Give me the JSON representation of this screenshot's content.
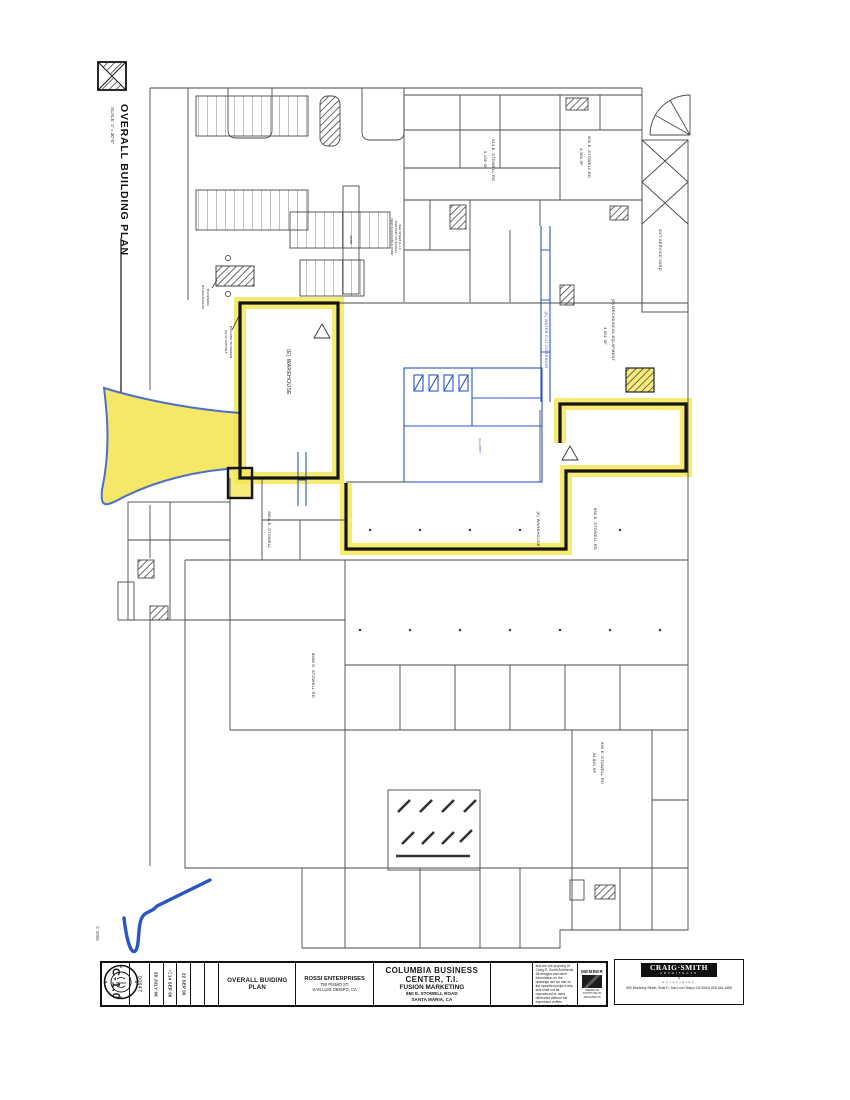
{
  "sheet": {
    "drawing_title": "OVERALL BUILDING PLAN",
    "drawing_scale": "SCALE: 1\" = 30'-0\"",
    "copyright": "© 2006",
    "plan_labels": {
      "warehouse_upper": "(E) WAREHOUSE",
      "warehouse_lower": "(E) WAREHOUSE",
      "suite_614_name": "614 E. STOWELL RD",
      "suite_614_area": "9,135 SF",
      "suite_600_name": "600 E. STOWELL RD",
      "suite_600_area": "4,385 SF",
      "water_cut_corridor": "(E) WATER CUT CORRIDOR",
      "mechanical_name": "(E) MECHANICAL EQUIPMENT",
      "mechanical_area": "4,591 SF",
      "ext_service_yard": "EXT SERVICE YARD",
      "ada_access_1": "(E) ADA ACCESS",
      "ada_access_2": "TO REMAIN",
      "asphalt_1": "(E) 12' ASPHALT",
      "asphalt_2": "BUILDING TO REMAIN",
      "ramp": "RAMP",
      "note_1": "NEW ACCESSIBLE RAMP",
      "note_2": "AND PATH OF TRAVEL",
      "note_3": "SEE SHEET A-1.0",
      "suite_860a": "860A E. STOWELL",
      "suite_860b": "860B E. STOWELL RD.",
      "suite_890_upper": "890 E. STOWELL RD",
      "suite_890_name": "890 E. STOWELL RD",
      "suite_890_area": "34,891 SF",
      "lobby": "(E) LOBBY"
    }
  },
  "titleblock": {
    "sheet_number": "C-1.0",
    "job_number": "00647",
    "revisions": [
      "28 JULY 06",
      "14 SEP 06",
      "22 SEP 06"
    ],
    "revision_marker": "△",
    "sheet_title": "OVERALL BUIDING PLAN",
    "owner": {
      "name": "ROSSI ENTERPRISES",
      "address1": "750 PISMO ST.",
      "address2": "SAN LUIS OBISPO, CA"
    },
    "project": {
      "line1": "COLUMBIA BUSINESS",
      "line2": "CENTER, T.I.",
      "line3": "FUSION MARKETING",
      "line4": "850 E. STOWELL ROAD",
      "line5": "SANTA MARIA, CA"
    },
    "disclaimer": "These drawings are instruments of service and are the property of Craig R. Smith Architects. All designs and other information on the drawings are for use on the specified project only and shall not be reproduced or used otherwise without the expressed written permission of Craig R. Smith, Architect.",
    "member": {
      "label": "MEMBER",
      "caption": "AMERICAN INSTITUTE OF ARCHITECTS"
    },
    "architect": {
      "name": "CRAIG·SMITH",
      "sub": "ARCHITECTS",
      "amp": "&",
      "assoc": "associates",
      "address": "890 Monterey Street, Suite D, San Luis Obispo CA 93401    805-544-1588"
    }
  }
}
